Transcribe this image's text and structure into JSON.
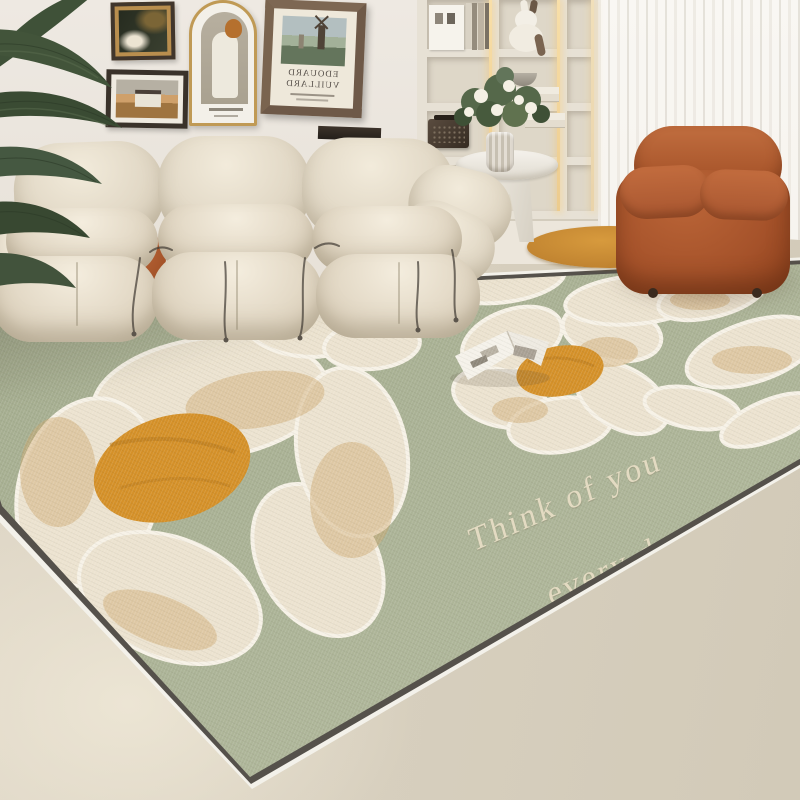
{
  "rug": {
    "text_line1": "Think of you",
    "text_line2": "every day",
    "base_color": "#a9b295",
    "petal_color": "#efe7d6",
    "petal_shade_color": "#d5bd96",
    "flower_center_color": "#d28f2f",
    "text_color": "#e6ddc4",
    "edge_binding_color": "#f3f1ea"
  },
  "wall_art": {
    "poster_line1": "EDOUARD",
    "poster_line2": "VUILLARD",
    "poster_text_mirrored": true
  },
  "palette": {
    "wall": "#e9e4dc",
    "wainscot_panel": "#a8a49c",
    "floor": "#dbd3c2",
    "curtain": "#f7f5f0",
    "sofa_cream": "#ece4d4",
    "accent_rust": "#ad5a31",
    "bookshelf": "#e7e1d5",
    "led_glow": "#f2d69e",
    "plant_green": "#3f5037",
    "frame_gold": "#b98e4e",
    "frame_dark": "#41362c",
    "frame_brown": "#6e5948"
  }
}
